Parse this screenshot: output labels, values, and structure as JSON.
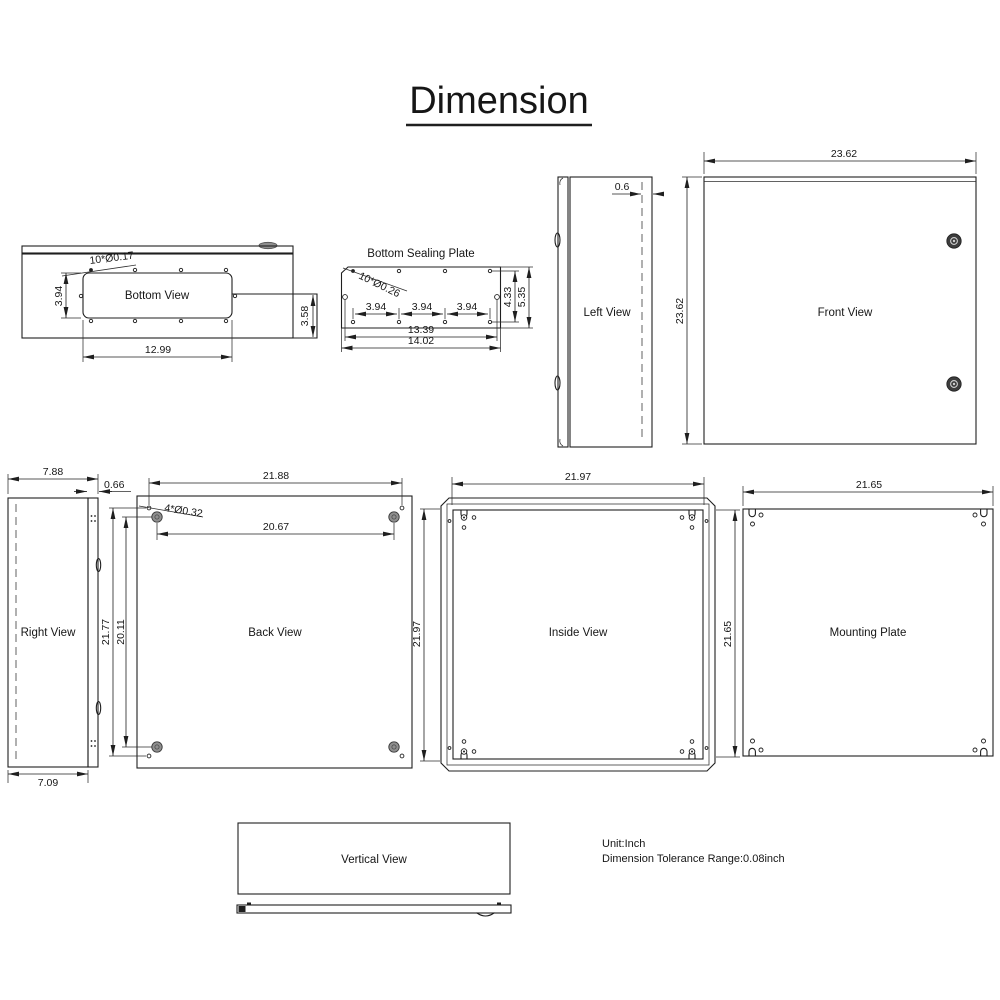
{
  "title": "Dimension",
  "notes": {
    "unit": "Unit:Inch",
    "tolerance": "Dimension Tolerance Range:0.08inch"
  },
  "colors": {
    "line": "#1f1f1f",
    "boss_fill": "#8f8f8f",
    "latch_fill": "#3d3d3d"
  },
  "views": {
    "bottom_view": {
      "label": "Bottom View",
      "dim_holes": "10*Ø0.17",
      "dim_cutout_height": "3.94",
      "dim_cutout_width": "12.99",
      "dim_flange_height": "3.58"
    },
    "bottom_sealing_plate": {
      "label": "Bottom Sealing Plate",
      "dim_holes": "10*Ø0.26",
      "dim_hole_pitch": "3.94",
      "dim_hole_rows": "4.33",
      "dim_height": "5.35",
      "dim_side_holes": "13.39",
      "dim_width": "14.02"
    },
    "left_view": {
      "label": "Left View",
      "dim_door_offset": "0.6"
    },
    "front_view": {
      "label": "Front View",
      "dim_width": "23.62",
      "dim_height": "23.62"
    },
    "right_view": {
      "label": "Right View",
      "dim_depth_top": "7.88",
      "dim_door": "0.66",
      "dim_depth_bottom": "7.09"
    },
    "back_view": {
      "label": "Back View",
      "dim_hole_width": "21.88",
      "dim_holes": "4*Ø0.32",
      "dim_boss_width": "20.67",
      "dim_hole_height": "21.77",
      "dim_boss_height": "20.11"
    },
    "inside_view": {
      "label": "Inside View",
      "dim_width": "21.97",
      "dim_height": "21.97",
      "dim_plate_height": "21.65"
    },
    "mounting_plate": {
      "label": "Mounting Plate",
      "dim_width": "21.65"
    },
    "vertical_view": {
      "label": "Vertical View"
    }
  }
}
